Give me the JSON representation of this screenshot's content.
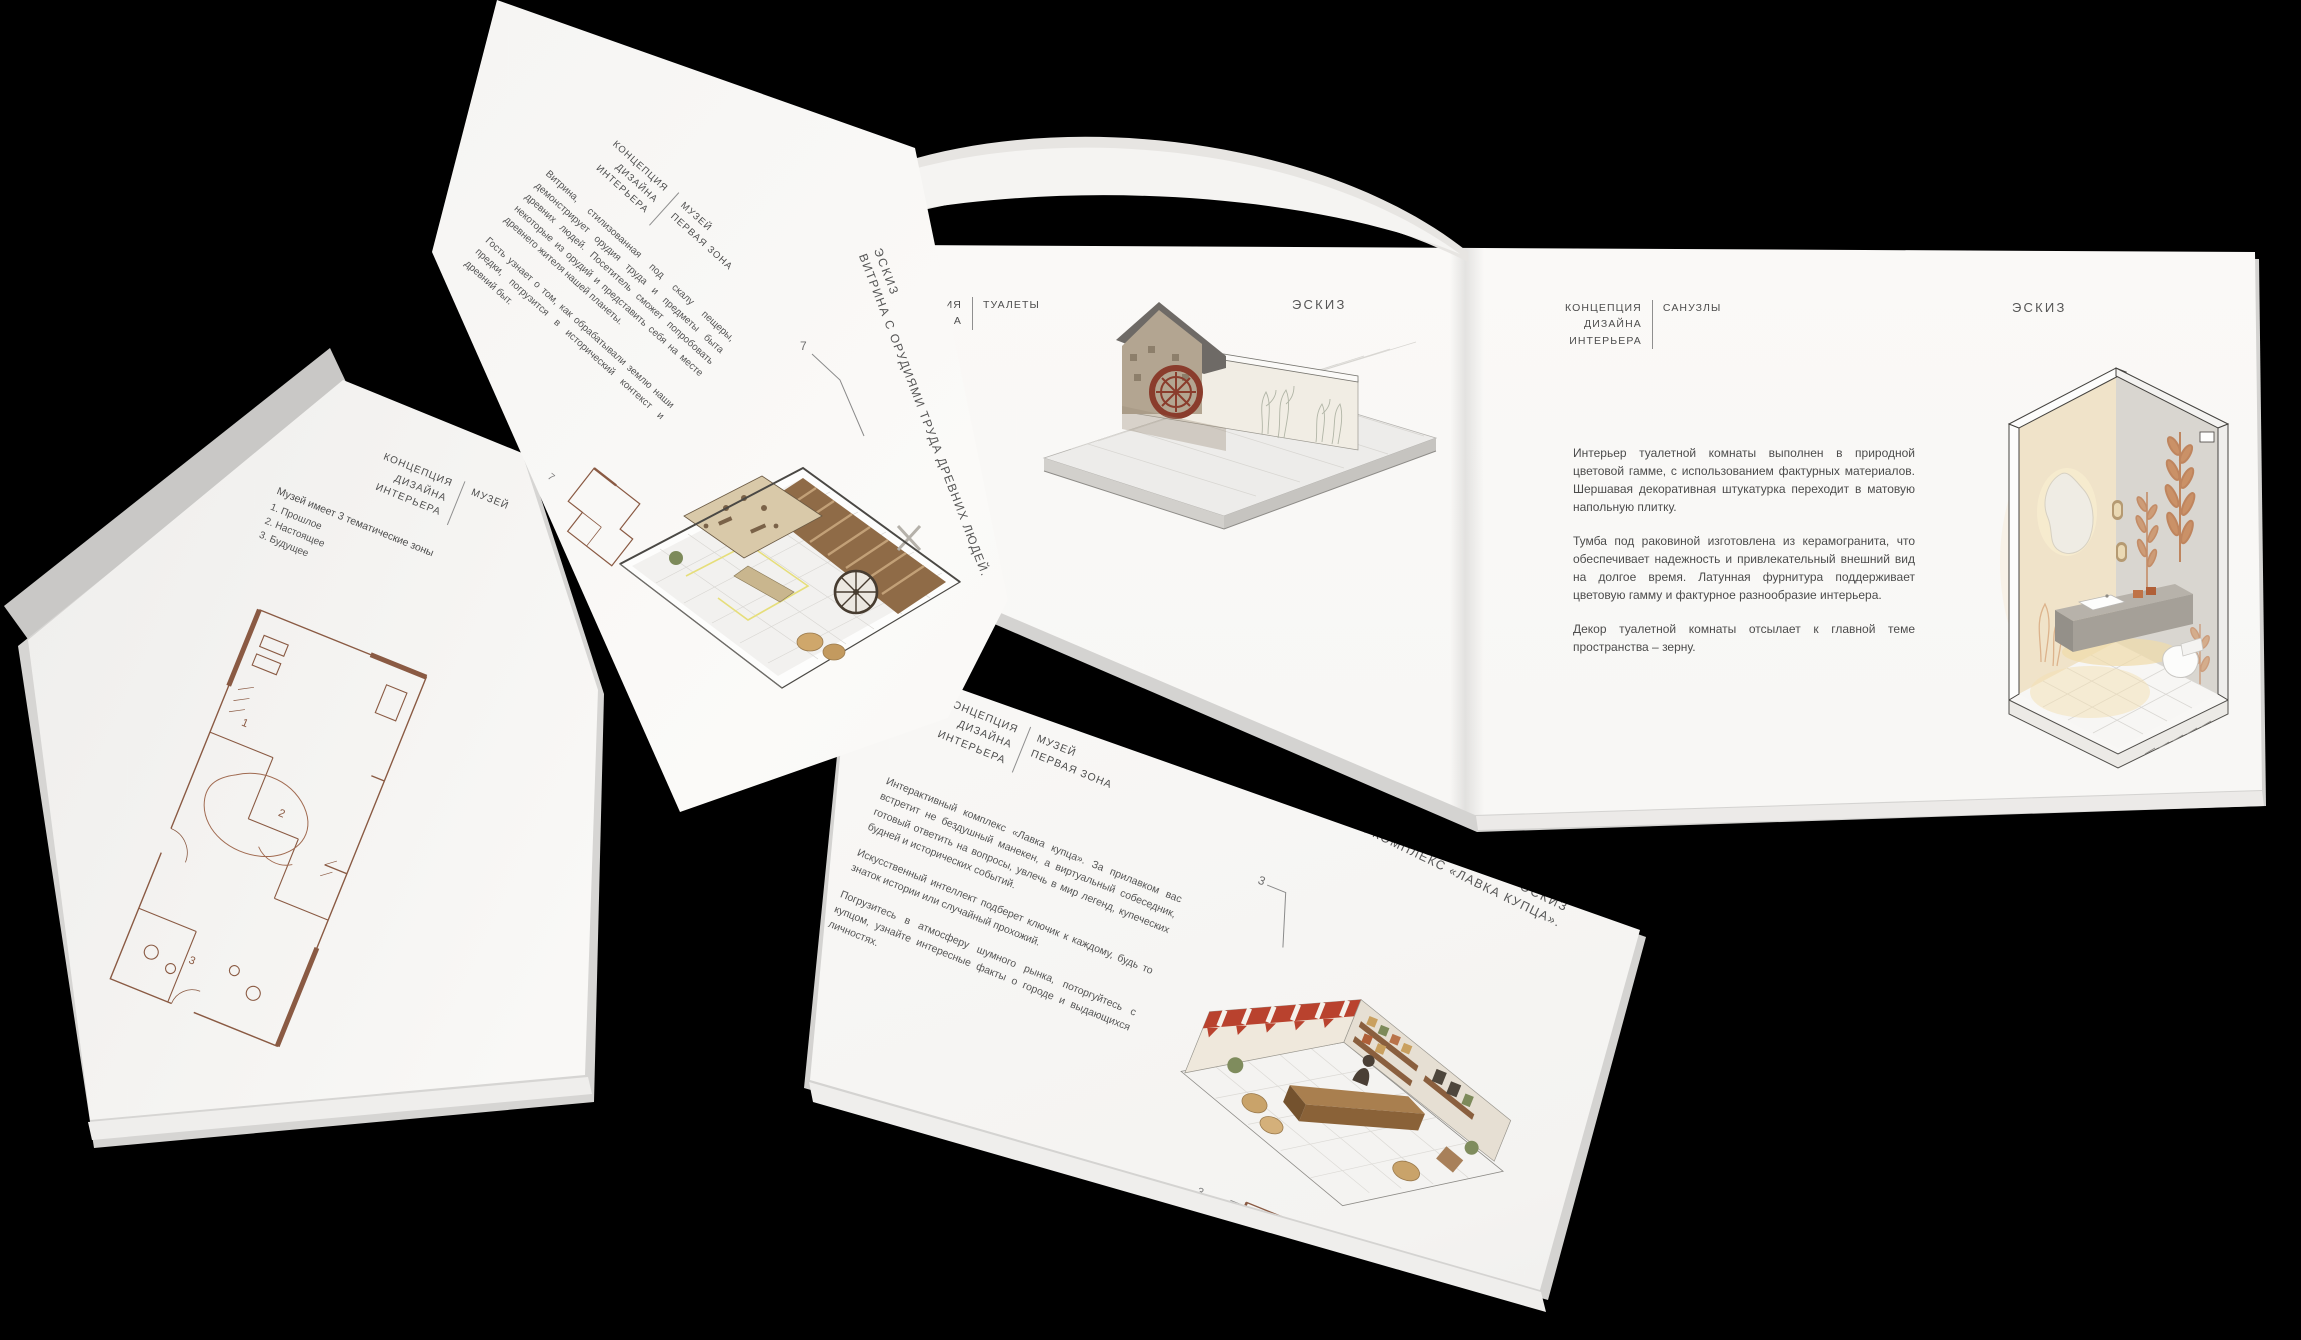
{
  "colors": {
    "background": "#000000",
    "page": "#f7f6f4",
    "text": "#4c4c4c",
    "plan_line": "#8a5a43",
    "terracotta": "#b9734a",
    "wheel_red": "#8a3c2c",
    "awning_red": "#b9422e",
    "accent_yellow": "#e6de7a"
  },
  "left_book": {
    "header": {
      "line1": "КОНЦЕПЦИЯ",
      "line2": "ДИЗАЙНА",
      "line3": "ИНТЕРЬЕРА",
      "section": "МУЗЕЙ"
    },
    "intro": "Музей имеет 3 тематические зоны",
    "zones": [
      "1. Прошлое",
      "2. Настоящее",
      "3. Будущее"
    ],
    "plan_labels": {
      "zone1": "1",
      "zone2": "2",
      "zone3": "3"
    }
  },
  "turning_page": {
    "header": {
      "line1": "КОНЦЕПЦИЯ",
      "line2": "ДИЗАЙНА",
      "line3": "ИНТЕРЬЕРА",
      "section_line1": "МУЗЕЙ",
      "section_line2": "ПЕРВАЯ ЗОНА"
    },
    "paragraph1": "Витрина, стилизованная под скалу пещеры, демонстрирует орудия труда и предметы быта древних людей. Посетитель сможет попробовать некоторые из орудий и представить себя на месте древнего жителя нашей планеты.",
    "paragraph2": "Гость узнает о том, как обрабатывали землю наши предки, погрузится в исторический контекст и древний быт.",
    "title_label": "ЭСКИЗ",
    "title": "ВИТРИНА С ОРУДИЯМИ ТРУДА ДРЕВНИХ ЛЮДЕЙ.",
    "callout": "7",
    "plan_callout": "7"
  },
  "toilets_page": {
    "header_fragment_line1": "ИЯ",
    "header_fragment_line2": "А",
    "section": "ТУАЛЕТЫ",
    "sketch_label": "ЭСКИЗ"
  },
  "bathroom_page": {
    "header": {
      "line1": "КОНЦЕПЦИЯ",
      "line2": "ДИЗАЙНА",
      "line3": "ИНТЕРЬЕРА",
      "section": "САНУЗЛЫ"
    },
    "sketch_label": "ЭСКИЗ",
    "paragraph1": "Интерьер туалетной комнаты выполнен в природной цветовой гамме, с использованием фактурных материалов. Шершавая декоративная штукатурка переходит в матовую напольную плитку.",
    "paragraph2": "Тумба под раковиной изготовлена из керамогранита, что обеспечивает надежность и привлекательный внешний вид на долгое время. Латунная фурнитура поддерживает цветовую гамму и фактурное разнообразие интерьера.",
    "paragraph3": "Декор туалетной комнаты отсылает к главной теме пространства – зерну."
  },
  "merchant_page": {
    "header": {
      "line1": "КОНЦЕПЦИЯ",
      "line2": "ДИЗАЙНА",
      "line3": "ИНТЕРЬЕРА",
      "section_line1": "МУЗЕЙ",
      "section_line2": "ПЕРВАЯ ЗОНА"
    },
    "paragraph1": "Интерактивный комплекс «Лавка купца». За прилавком вас встретит не бездушный манекен, а виртуальный собеседник, готовый ответить на вопросы, увлечь в мир легенд, купеческих будней и исторических событий.",
    "paragraph2": "Искусственный интеллект подберет ключик к каждому, будь то знаток истории или случайный прохожий.",
    "paragraph3": "Погрузитесь в атмосферу шумного рынка, поторгуйтесь с купцом, узнайте интересные факты о городе и выдающихся личностях.",
    "title_label": "ЭСКИЗ",
    "title": "ИНТЕРАКТИВНЫЙ КОМПЛЕКС «ЛАВКА КУПЦА».",
    "callout": "3",
    "plan_callout": "3"
  }
}
